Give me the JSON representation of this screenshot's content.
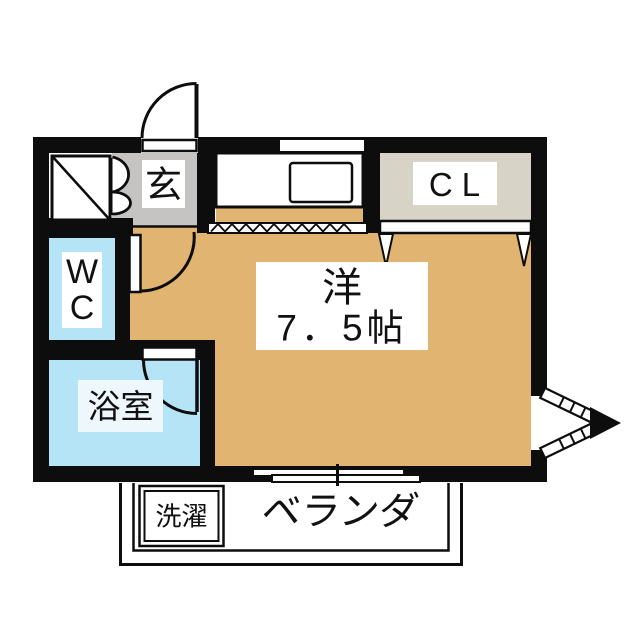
{
  "floor_plan": {
    "type": "apartment-floorplan",
    "rooms": {
      "entry": {
        "label": "玄"
      },
      "closet": {
        "label": "CL"
      },
      "toilet": {
        "line1": "W",
        "line2": "C"
      },
      "bathroom": {
        "label": "浴室"
      },
      "living": {
        "name": "洋",
        "size": "7．5帖"
      },
      "veranda": {
        "label": "ベランダ"
      },
      "laundry": {
        "label": "洗濯"
      }
    },
    "colors": {
      "wall": "#0d0d0d",
      "floor": "#e2b472",
      "entry": "#c5c4c3",
      "closet": "#d7d3c7",
      "water": "#b4e4f5",
      "bathlabel": "#eef8fc"
    }
  }
}
